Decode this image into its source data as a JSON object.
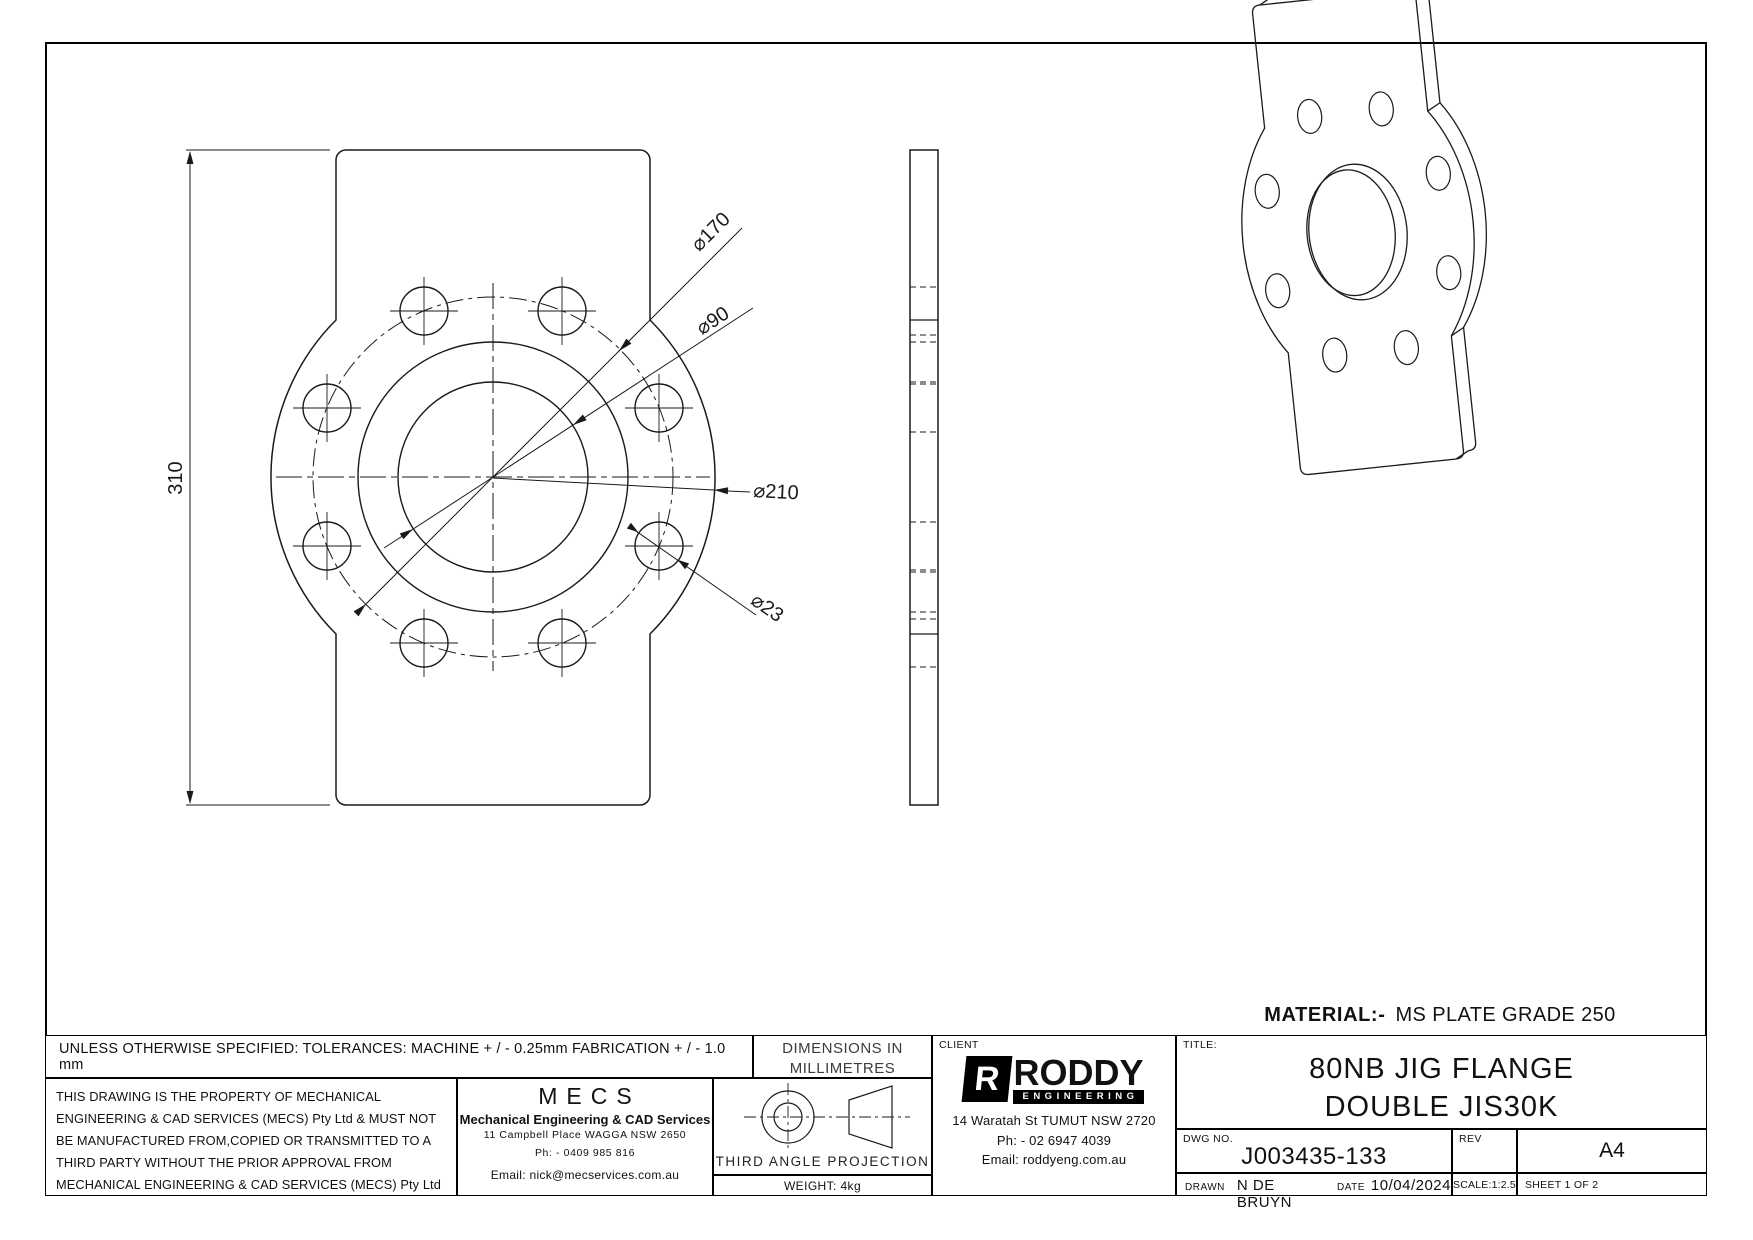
{
  "views": {
    "front": {
      "dim_height": "310",
      "dim_bcd": "⌀170",
      "dim_bore": "⌀90",
      "dim_od": "⌀210",
      "dim_hole": "⌀23"
    },
    "material_label": "MATERIAL:-",
    "material_value": "MS PLATE GRADE 250"
  },
  "titleblock": {
    "tolerances": "UNLESS OTHERWISE SPECIFIED: TOLERANCES: MACHINE + / - 0.25mm  FABRICATION + / - 1.0 mm",
    "note_line1": "THIS DRAWING IS THE PROPERTY OF MECHANICAL",
    "note_line2": "ENGINEERING & CAD SERVICES (MECS) Pty Ltd & MUST NOT",
    "note_line3": "BE MANUFACTURED FROM,COPIED OR TRANSMITTED TO A",
    "note_line4": "THIRD PARTY WITHOUT THE PRIOR APPROVAL FROM",
    "note_line5": "MECHANICAL ENGINEERING & CAD SERVICES (MECS) Pty Ltd",
    "mecs": {
      "logo": "MECS",
      "name": "Mechanical Engineering & CAD Services",
      "address": "11 Campbell Place WAGGA NSW 2650",
      "phone": "Ph: - 0409 985 816",
      "email": "Email: nick@mecservices.com.au"
    },
    "units_line1": "DIMENSIONS IN",
    "units_line2": "MILLIMETRES",
    "projection_label": "THIRD ANGLE PROJECTION",
    "weight": "WEIGHT: 4kg",
    "client": {
      "label": "CLIENT",
      "logo_initial": "R",
      "logo_name": "RODDY",
      "logo_subtitle": "ENGINEERING",
      "address": "14 Waratah St TUMUT NSW 2720",
      "phone": "Ph: - 02 6947 4039",
      "email": "Email: roddyeng.com.au"
    },
    "title_label": "TITLE:",
    "title_line1": "80NB JIG FLANGE",
    "title_line2": "DOUBLE JIS30K",
    "dwg_label": "DWG NO.",
    "dwg_no": "J003435-133",
    "rev_label": "REV",
    "rev_value": "",
    "paper_size": "A4",
    "drawn_label": "DRAWN",
    "drawn_by": "N DE BRUYN",
    "date_label": "DATE",
    "date_value": "10/04/2024",
    "scale": "SCALE:1:2.5",
    "sheet": "SHEET 1 OF 2"
  }
}
